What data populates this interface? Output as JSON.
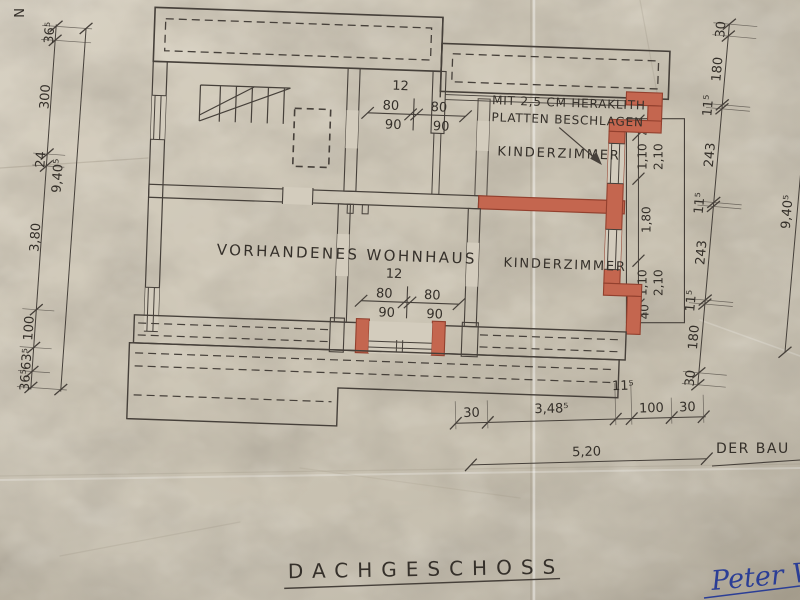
{
  "drawing_title": "DACHGESCHOSS",
  "north_mark": "N",
  "rooms": {
    "existing_house": "VORHANDENES WOHNHAUS",
    "kinderzimmer_upper": "KINDERZIMMER",
    "kinderzimmer_lower": "KINDERZIMMER"
  },
  "note": {
    "line1": "MIT 2,5 CM HERAKLITH",
    "line2": "PLATTEN BESCHLAGEN"
  },
  "approval": {
    "label": "DER BAU",
    "signature": "Peter Wi"
  },
  "dimensions": {
    "left_chain": [
      "36⁵",
      "300",
      "24",
      "3,80",
      "100",
      "63⁵",
      "36⁵"
    ],
    "left_total": "9,40⁵",
    "right_chain": [
      "30",
      "180",
      "11⁵",
      "243",
      "11⁵",
      "243",
      "11⁵",
      "180",
      "30"
    ],
    "right_total": "9,40⁵",
    "bottom_chain": [
      "30",
      "3,48⁵",
      "11⁵",
      "100",
      "30"
    ],
    "bottom_total": "5,20",
    "door_upper": {
      "width": "12",
      "clear_left": "80",
      "clear_right": "80",
      "raw_left": "90",
      "raw_right": "90"
    },
    "door_lower": {
      "width": "12",
      "clear_left": "80",
      "clear_right": "80",
      "raw_left": "90",
      "raw_right": "90"
    },
    "right_wall_openings": [
      "40",
      "1,10",
      "2,10",
      "1,80",
      "1,10",
      "2,10",
      "40"
    ]
  },
  "colors": {
    "paper": "#cdc6b6",
    "ink": "#3e382e",
    "new_construction": "#c4664f",
    "signature_ink": "#2b3e96"
  }
}
